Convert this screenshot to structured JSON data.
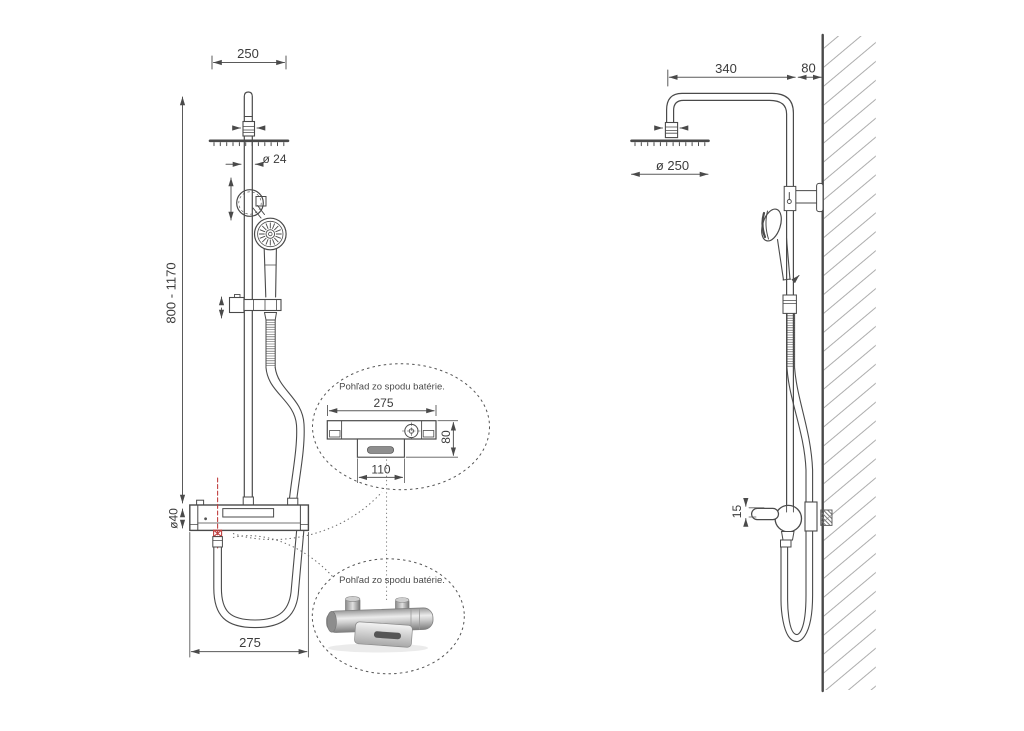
{
  "front_view": {
    "dims": {
      "head_width": "250",
      "pole_diameter": "ø 24",
      "height_range": "800 - 1170",
      "mixer_diameter": "ø40",
      "mixer_width": "275"
    }
  },
  "side_view": {
    "dims": {
      "arm_depth": "340",
      "wall_offset": "80",
      "head_diameter": "ø 250",
      "spout_offset": "15"
    }
  },
  "detail_top": {
    "caption": "Pohľad zo spodu batérie.",
    "dims": {
      "width": "275",
      "depth": "80",
      "spout_width": "110"
    }
  },
  "detail_bottom": {
    "caption": "Pohľad zo spodu batérie."
  },
  "colors": {
    "line": "#4a4a4a",
    "dimension": "#5a5a5a",
    "text": "#3c3c3c",
    "accent_red": "#c04040",
    "hatch": "#adadad"
  }
}
